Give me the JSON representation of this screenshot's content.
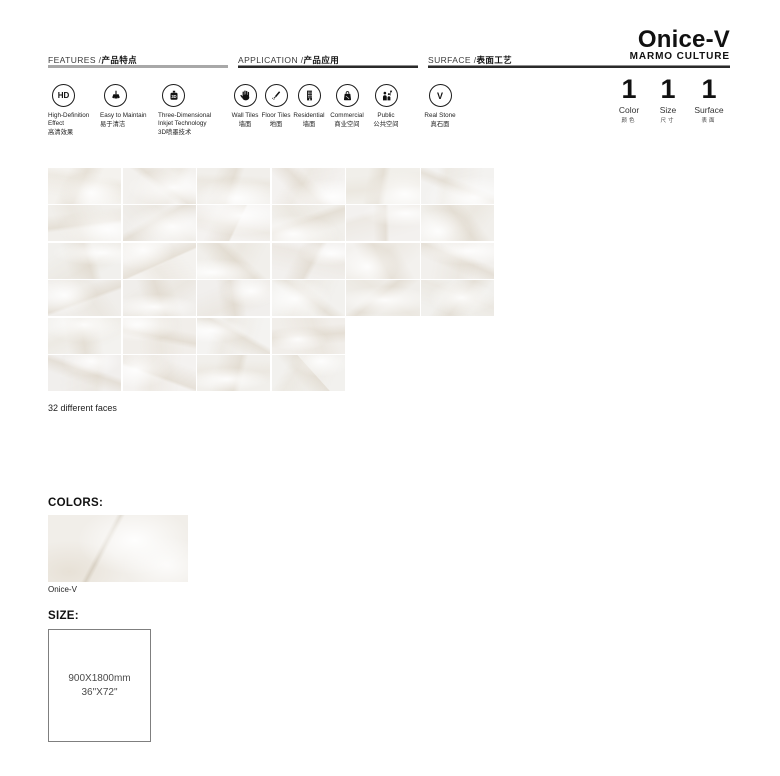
{
  "brand": {
    "product_name": "Onice-V",
    "brand_name": "MARMO CULTURE"
  },
  "sections": {
    "features": {
      "label_en": "FEATURES /",
      "label_zh": "产品特点",
      "items": [
        {
          "icon": "hd-icon",
          "glyph": "HD",
          "en": "High-Definition Effect",
          "zh": "高清效果"
        },
        {
          "icon": "brush-icon",
          "en": "Easy to Maintain",
          "zh": "易于清洁"
        },
        {
          "icon": "inkjet-3d-icon",
          "glyph": "3D",
          "en": "Three-Dimensional Inkjet Technology",
          "zh": "3D喷墨技术"
        }
      ]
    },
    "application": {
      "label_en": "APPLICATION /",
      "label_zh": "产品应用",
      "items": [
        {
          "icon": "hand-icon",
          "en": "Wall Tiles",
          "zh": "墙面"
        },
        {
          "icon": "pencil-icon",
          "en": "Floor Tiles",
          "zh": "地面"
        },
        {
          "icon": "building-icon",
          "en": "Residential",
          "zh": "墙面"
        },
        {
          "icon": "shopping-bag-icon",
          "en": "Commercial",
          "zh": "商业空间"
        },
        {
          "icon": "people-icon",
          "en": "Public",
          "zh": "公共空间"
        }
      ]
    },
    "surface": {
      "label_en": "SURFACE /",
      "label_zh": "表面工艺",
      "items": [
        {
          "icon": "v-icon",
          "glyph": "V",
          "en": "Real Stone",
          "zh": "真石面"
        }
      ]
    }
  },
  "stats": [
    {
      "value": "1",
      "label": "Color",
      "zh": "颜色"
    },
    {
      "value": "1",
      "label": "Size",
      "zh": "尺寸"
    },
    {
      "value": "1",
      "label": "Surface",
      "zh": "表面"
    }
  ],
  "tile_grid": {
    "caption": "32 different faces",
    "count": 32,
    "rows": [
      6,
      6,
      6,
      6,
      4,
      4
    ]
  },
  "colors_section": {
    "heading": "COLORS:",
    "swatch_label": "Onice-V"
  },
  "size_section": {
    "heading": "SIZE:",
    "dimensions_mm": "900X1800mm",
    "dimensions_in": "36\"X72\""
  },
  "colors": {
    "line_dark": "#2a2a2a",
    "line_gray": "#a8a8a8",
    "tile_base": "#f1eee9",
    "text": "#1a1a1a"
  }
}
